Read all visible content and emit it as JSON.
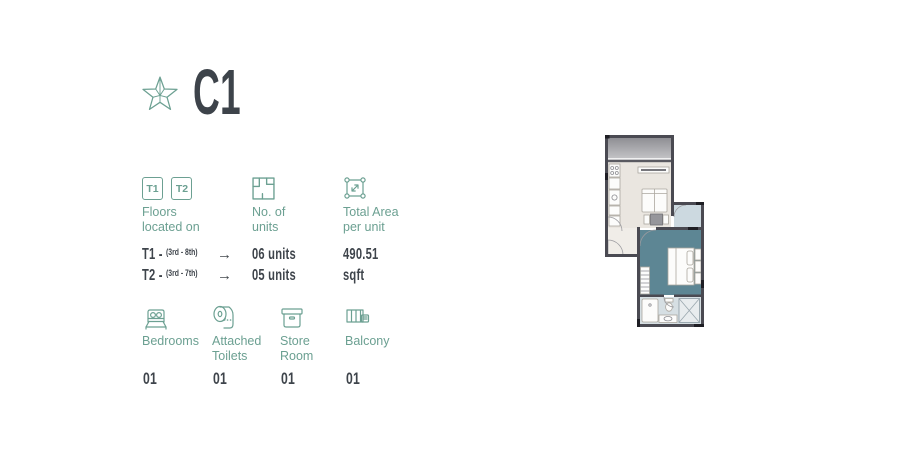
{
  "header": {
    "unit_code": "C1",
    "star_icon": "outlined-faceted-star"
  },
  "colors": {
    "accent": "#6ca092",
    "dark_text": "#3e444b",
    "wall": "#4a4a52",
    "living_floor": "#eae6e0",
    "entry_floor": "#f0ede8",
    "bedroom_floor": "#5d8694",
    "pale_room": "#ccd9e0",
    "bath_floor": "#d6dfe3",
    "balcony_gray": "#97979c"
  },
  "floors": {
    "icon_boxes": [
      "T1",
      "T2"
    ],
    "label_line1": "Floors",
    "label_line2": "located on",
    "rows": [
      {
        "tower": "T1 -",
        "range": "(3rd - 8th)",
        "arrow": "→",
        "units": "06 units"
      },
      {
        "tower": "T2 -",
        "range": "(3rd - 7th)",
        "arrow": "→",
        "units": "05 units"
      }
    ]
  },
  "units": {
    "label_line1": "No. of",
    "label_line2": "units"
  },
  "area": {
    "label_line1": "Total Area",
    "label_line2": "per unit",
    "value": "490.51",
    "unit": "sqft"
  },
  "features": [
    {
      "icon": "bed-icon",
      "label_line1": "Bedrooms",
      "label_line2": "",
      "count": "01"
    },
    {
      "icon": "toilet-roll-icon",
      "label_line1": "Attached",
      "label_line2": "Toilets",
      "count": "01"
    },
    {
      "icon": "store-box-icon",
      "label_line1": "Store",
      "label_line2": "Room",
      "count": "01"
    },
    {
      "icon": "balcony-icon",
      "label_line1": "Balcony",
      "label_line2": "",
      "count": "01"
    }
  ],
  "floorplan": {
    "description": "C1 unit floor plan with living/kitchen area, balcony, bedroom and attached bathroom"
  }
}
